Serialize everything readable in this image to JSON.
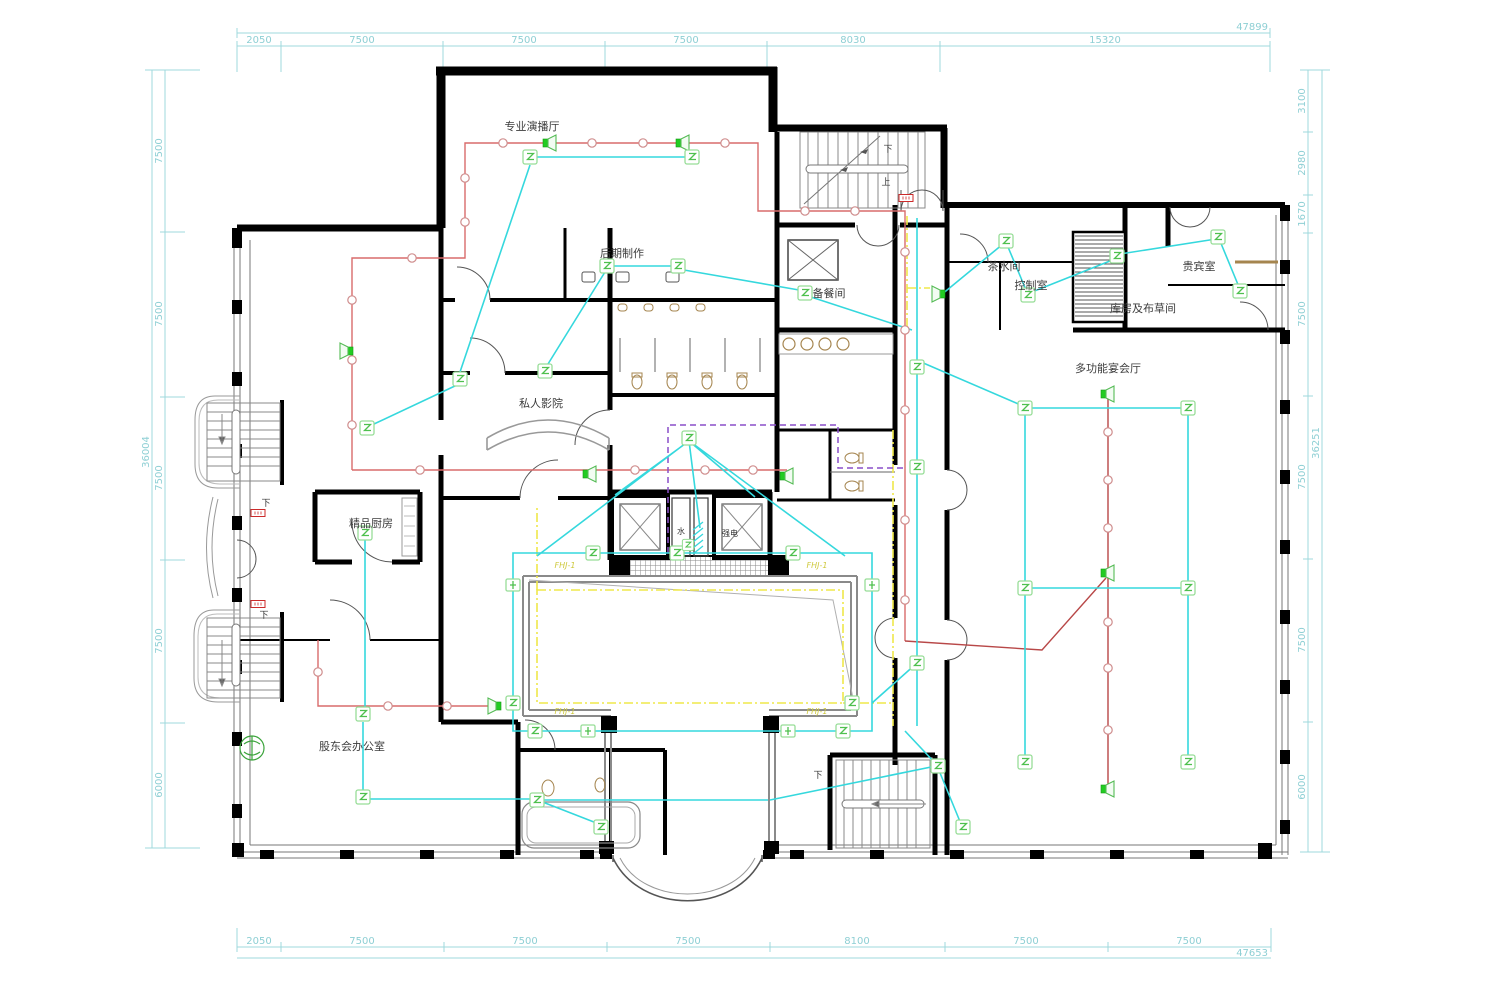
{
  "dimensions": {
    "top": {
      "total": "47899",
      "segments": [
        "2050",
        "7500",
        "7500",
        "7500",
        "8030",
        "15320"
      ]
    },
    "bottom": {
      "total": "47653",
      "segments": [
        "2050",
        "7500",
        "7500",
        "7500",
        "8100",
        "7500",
        "7500"
      ]
    },
    "left": {
      "total": "36004",
      "segments": [
        "7500",
        "7500",
        "7500",
        "7500",
        "6000"
      ]
    },
    "right": {
      "total": "36251",
      "segments": [
        "3100",
        "2980",
        "1670",
        "7500",
        "7500",
        "7500",
        "6000"
      ]
    }
  },
  "rooms": {
    "studio": "专业演播厅",
    "post_production": "后期制作",
    "pantry": "备餐间",
    "tea_room": "茶水间",
    "control_room": "控制室",
    "vip_room": "贵宾室",
    "storage_linen": "库房及布草间",
    "banquet_hall": "多功能宴会厅",
    "private_cinema": "私人影院",
    "boutique_kitchen": "精品厨房",
    "shareholders_office": "股东会办公室"
  },
  "annotations": {
    "down": "下",
    "up": "上",
    "water_riser": "水",
    "power_riser": "强电",
    "fire_shutter": "FHJ-1"
  },
  "legend_colors": {
    "dimension_line": "#8ecfd4",
    "wall": "#000000",
    "broadcast_speaker_line": "#d96b6b",
    "signal_line": "#35d8dd",
    "cable_tray_line": "#efe84a",
    "zone_boundary_line": "#8a4fc8",
    "device_symbol": "#2ecc2e"
  }
}
